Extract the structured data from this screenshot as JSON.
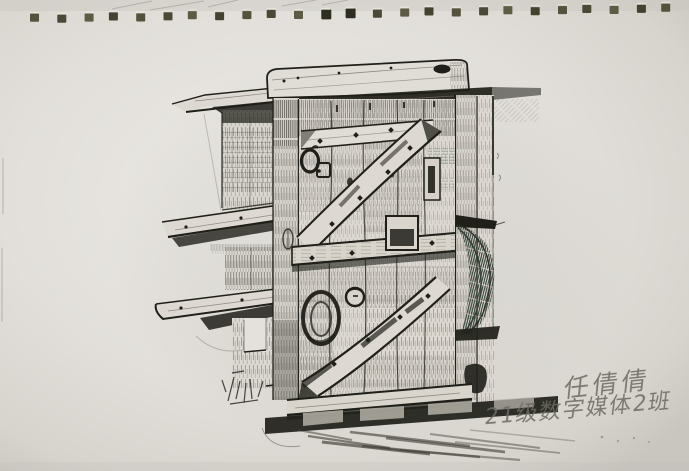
{
  "scene": {
    "subject": "ink pen sketch of an old wooden braced plank door in a rough timber frame, with shelf beams on the left wall, drawn on a spiral-bound sketchbook page"
  },
  "handwriting": {
    "line1": "任倩倩",
    "line2": "21级数字媒体2班"
  },
  "binding": {
    "hole_count": 25,
    "dark_hole_indices": [
      11,
      12
    ]
  },
  "colors": {
    "paper": "#e2dfda",
    "paper_light": "#eceae5",
    "paper_edge": "#c9c6c0",
    "wood_light": "#ddd9d2",
    "ink": "#201f19",
    "ink_soft": "#3c3b32",
    "green_tint": "#4e6b5d",
    "crescent_green": "#2e3d32",
    "pencil": "#a19e96",
    "handwriting": "#6d6b62",
    "hole_olive": "#54523c",
    "hole_dark": "#2e2d21"
  }
}
